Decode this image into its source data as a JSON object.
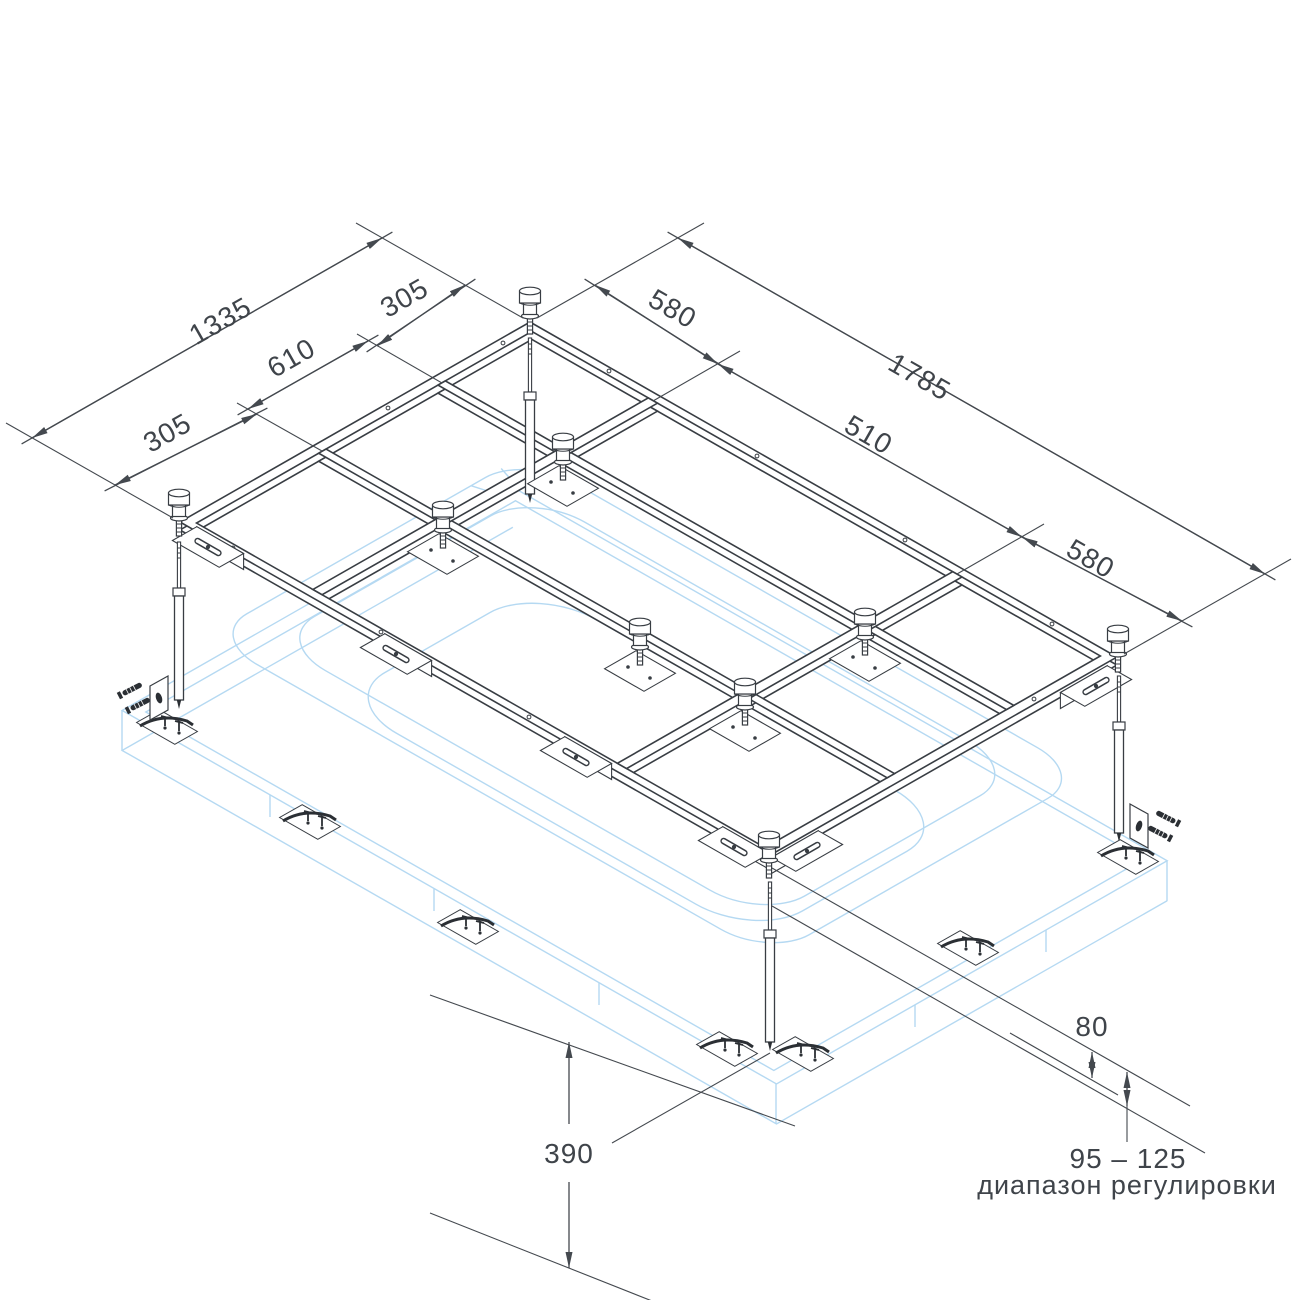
{
  "diagram": {
    "type": "bathtub-frame-installation-drawing",
    "dimensions": {
      "width_total": "1335",
      "width_top": "305",
      "width_mid": "610",
      "width_bottom": "305",
      "length_total": "1785",
      "length_left": "580",
      "length_mid": "510",
      "length_right": "580",
      "height_floor": "390",
      "gap": "80",
      "adjust_range": "95 – 125",
      "adjust_note": "диапазон регулировки"
    },
    "colors": {
      "line": "#383d43",
      "dimension": "#44494f",
      "tub_outline": "#b5d9f2",
      "background": "#ffffff"
    }
  }
}
